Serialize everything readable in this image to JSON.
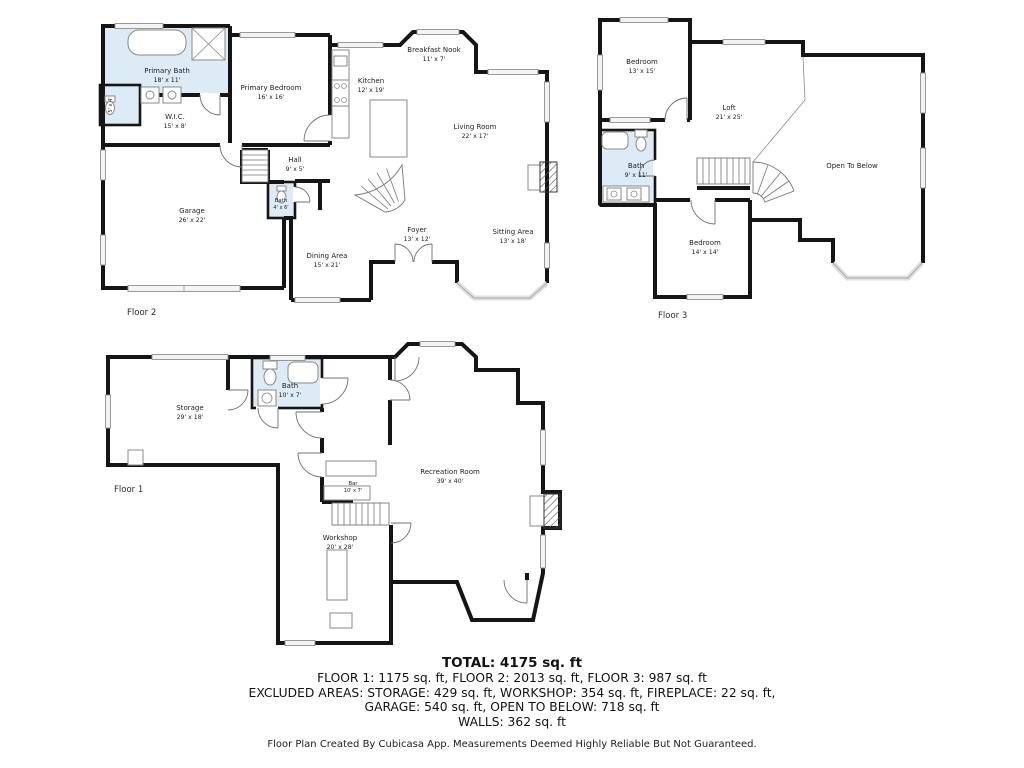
{
  "colors": {
    "wall": "#151515",
    "bath_fill": "#dcebf5",
    "window_fill": "#f3f3f3",
    "fixture_line": "#8a8a8a",
    "label_text": "#1f1f1f"
  },
  "floor2": {
    "label": "Floor 2",
    "rooms": {
      "primary_bath": {
        "name": "Primary Bath",
        "dims": "18' x 11'"
      },
      "primary_bedroom": {
        "name": "Primary Bedroom",
        "dims": "16' x 16'"
      },
      "wic": {
        "name": "W.I.C.",
        "dims": "15' x 8'"
      },
      "closet": {
        "dims": "5' x 4'"
      },
      "hall": {
        "name": "Hall",
        "dims": "9' x 5'"
      },
      "garage": {
        "name": "Garage",
        "dims": "26' x 22'"
      },
      "bath": {
        "name": "Bath",
        "dims": "4' x 6'"
      },
      "kitchen": {
        "name": "Kitchen",
        "dims": "12' x 19'"
      },
      "breakfast_nook": {
        "name": "Breakfast Nook",
        "dims": "11' x 7'"
      },
      "living_room": {
        "name": "Living Room",
        "dims": "22' x 17'"
      },
      "foyer": {
        "name": "Foyer",
        "dims": "13' x 12'"
      },
      "dining_area": {
        "name": "Dining Area",
        "dims": "15' x 21'"
      },
      "sitting_area": {
        "name": "Sitting Area",
        "dims": "13' x 18'"
      }
    }
  },
  "floor3": {
    "label": "Floor 3",
    "rooms": {
      "bedroom_upper": {
        "name": "Bedroom",
        "dims": "13' x 15'"
      },
      "loft": {
        "name": "Loft",
        "dims": "21' x 25'"
      },
      "bath": {
        "name": "Bath",
        "dims": "9' x 11'"
      },
      "bedroom_lower": {
        "name": "Bedroom",
        "dims": "14' x 14'"
      },
      "open_to_below": {
        "name": "Open To Below"
      }
    }
  },
  "floor1": {
    "label": "Floor 1",
    "rooms": {
      "storage": {
        "name": "Storage",
        "dims": "29' x 18'"
      },
      "bath": {
        "name": "Bath",
        "dims": "10' x 7'"
      },
      "recreation_room": {
        "name": "Recreation Room",
        "dims": "39' x 40'"
      },
      "bar": {
        "name": "Bar",
        "dims": "10' x 7'"
      },
      "workshop": {
        "name": "Workshop",
        "dims": "20' x 28'"
      }
    }
  },
  "summary": {
    "total": "TOTAL: 4175 sq. ft",
    "floors": "FLOOR 1: 1175 sq. ft, FLOOR 2: 2013 sq. ft, FLOOR 3: 987 sq. ft",
    "excluded_1": "EXCLUDED AREAS: STORAGE: 429 sq. ft, WORKSHOP: 354 sq. ft, FIREPLACE: 22 sq. ft,",
    "excluded_2": "GARAGE: 540 sq. ft, OPEN TO BELOW: 718 sq. ft",
    "walls": "WALLS: 362 sq. ft",
    "disclaimer": "Floor Plan Created By Cubicasa App. Measurements Deemed Highly Reliable But Not Guaranteed."
  }
}
